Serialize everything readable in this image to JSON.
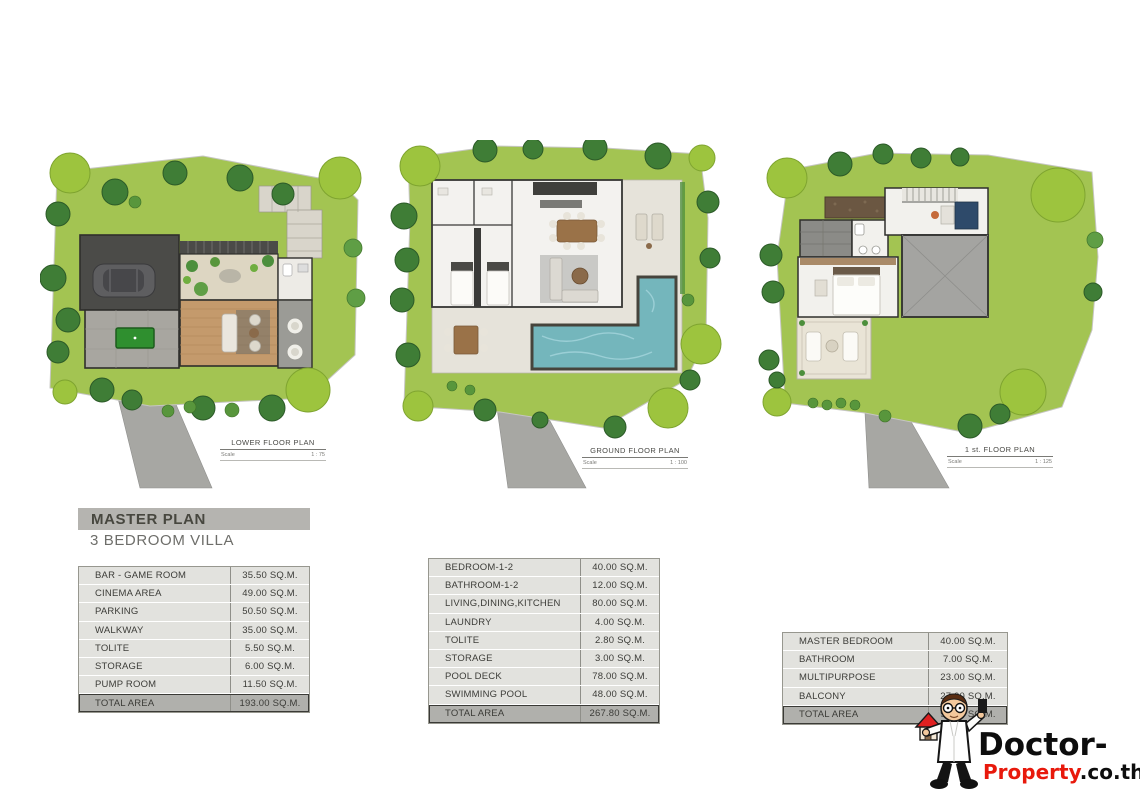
{
  "document": {
    "title": "MASTER PLAN",
    "subtitle": "3 BEDROOM VILLA"
  },
  "plans": [
    {
      "id": "lower",
      "caption": "LOWER FLOOR PLAN",
      "scale_label": "Scale",
      "scale_value": "1 : 75"
    },
    {
      "id": "ground",
      "caption": "GROUND FLOOR PLAN",
      "scale_label": "Scale",
      "scale_value": "1 : 100"
    },
    {
      "id": "first",
      "caption": "1 st. FLOOR PLAN",
      "scale_label": "Scale",
      "scale_value": "1 : 125"
    }
  ],
  "area_tables": [
    {
      "plan": "lower",
      "rows": [
        {
          "label": "BAR - GAME ROOM",
          "value": "35.50 SQ.M."
        },
        {
          "label": "CINEMA AREA",
          "value": "49.00 SQ.M."
        },
        {
          "label": "PARKING",
          "value": "50.50 SQ.M."
        },
        {
          "label": "WALKWAY",
          "value": "35.00 SQ.M."
        },
        {
          "label": "TOLITE",
          "value": "5.50 SQ.M."
        },
        {
          "label": "STORAGE",
          "value": "6.00 SQ.M."
        },
        {
          "label": "PUMP ROOM",
          "value": "11.50 SQ.M."
        }
      ],
      "total": {
        "label": "TOTAL AREA",
        "value": "193.00 SQ.M."
      }
    },
    {
      "plan": "ground",
      "rows": [
        {
          "label": "BEDROOM-1-2",
          "value": "40.00 SQ.M."
        },
        {
          "label": "BATHROOM-1-2",
          "value": "12.00 SQ.M."
        },
        {
          "label": "LIVING,DINING,KITCHEN",
          "value": "80.00 SQ.M."
        },
        {
          "label": "LAUNDRY",
          "value": "4.00 SQ.M."
        },
        {
          "label": "TOLITE",
          "value": "2.80 SQ.M."
        },
        {
          "label": "STORAGE",
          "value": "3.00 SQ.M."
        },
        {
          "label": "POOL DECK",
          "value": "78.00 SQ.M."
        },
        {
          "label": "SWIMMING POOL",
          "value": "48.00 SQ.M."
        }
      ],
      "total": {
        "label": "TOTAL AREA",
        "value": "267.80 SQ.M."
      }
    },
    {
      "plan": "first",
      "rows": [
        {
          "label": "MASTER BEDROOM",
          "value": "40.00 SQ.M."
        },
        {
          "label": "BATHROOM",
          "value": "7.00 SQ.M."
        },
        {
          "label": "MULTIPURPOSE",
          "value": "23.00 SQ.M."
        },
        {
          "label": "BALCONY",
          "value": "27.00 SQ.M."
        }
      ],
      "total": {
        "label": "TOTAL AREA",
        "value": "97.00 SQ.M."
      }
    }
  ],
  "logo": {
    "brand_black": "Doctor-",
    "brand_red": "Property",
    "brand_suffix": ".co.th",
    "mascot": "doctor-holding-house-icon"
  },
  "theme": {
    "grass": "#a3c452",
    "tree_dark": "#3f7d36",
    "tree_light": "#9dc43e",
    "pool": "#74b6bc",
    "driveway": "#a7a7a3",
    "title_bar_bg": "#b5b4b0",
    "table_row_bg": "#e2e2de",
    "table_total_bg": "#b0b0ac",
    "accent_red": "#e8190c"
  }
}
